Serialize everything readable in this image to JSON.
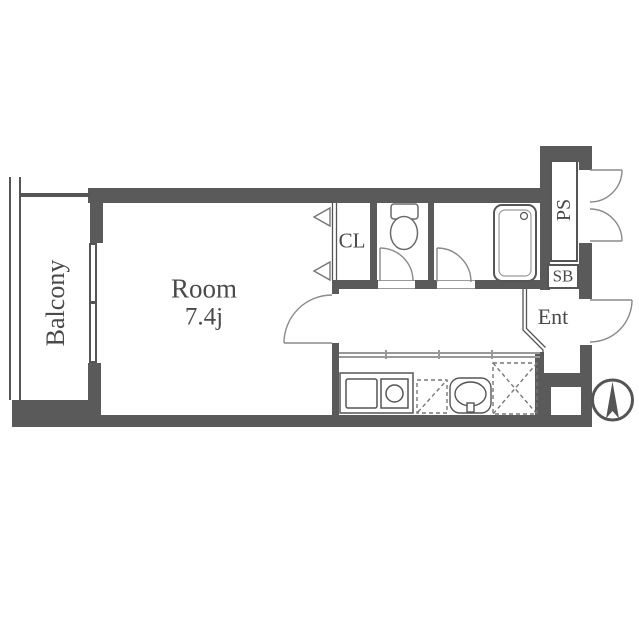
{
  "floorplan": {
    "room": {
      "label": "Room",
      "size": "7.4j"
    },
    "balcony": {
      "label": "Balcony"
    },
    "closet": {
      "label": "CL"
    },
    "pipe_space": {
      "label": "PS"
    },
    "shoe_box": {
      "label": "SB"
    },
    "entrance": {
      "label": "Ent"
    },
    "fixtures": [
      "bathtub",
      "toilet",
      "kitchen-counter",
      "stove-burner",
      "washbasin",
      "refrigerator-space",
      "washing-machine-space",
      "closet-bifold-door",
      "room-door",
      "toilet-door",
      "bath-door",
      "ps-double-door",
      "entrance-door",
      "window",
      "balcony-rail",
      "compass-north"
    ],
    "colors": {
      "wall": "#5a5a5a",
      "line": "#555555",
      "fixture_line": "#888888",
      "light_line": "#999999",
      "text": "#4a4a4a",
      "background": "#ffffff"
    }
  }
}
